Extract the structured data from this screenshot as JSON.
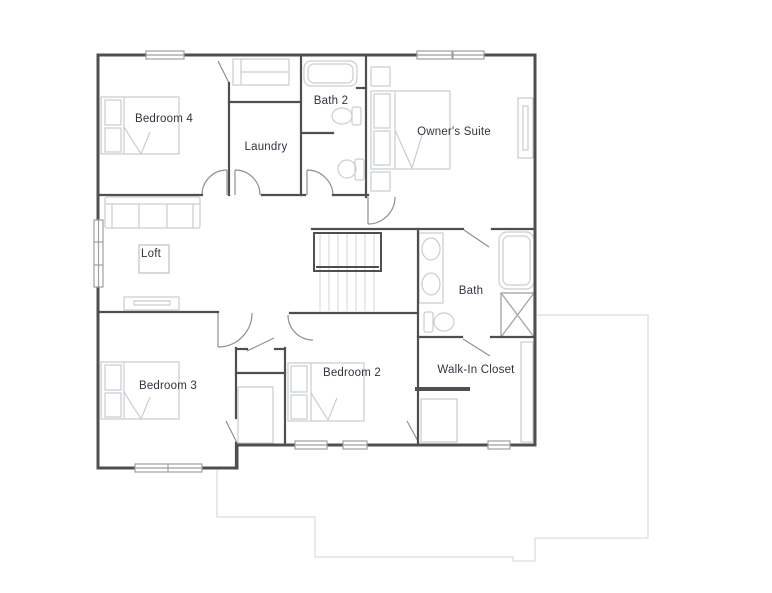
{
  "plan": {
    "type": "floor-plan",
    "floor": "second-floor",
    "background": "#ffffff",
    "colors": {
      "wall": "#4f4f4f",
      "interior_wall": "#585858",
      "door": "#8f8f8f",
      "window_frame": "#9f9f9f",
      "furniture": "#c9cdd1",
      "stair_tread": "#d6d6d6",
      "lower_floor_outline": "#e2e2e2",
      "label_text": "#31343d"
    },
    "rooms": {
      "bedroom4": {
        "label": "Bedroom 4"
      },
      "laundry": {
        "label": "Laundry"
      },
      "bath2": {
        "label": "Bath 2"
      },
      "owners_suite": {
        "label": "Owner's Suite"
      },
      "loft": {
        "label": "Loft"
      },
      "bath": {
        "label": "Bath"
      },
      "bedroom3": {
        "label": "Bedroom 3"
      },
      "bedroom2": {
        "label": "Bedroom 2"
      },
      "walk_in_closet": {
        "label": "Walk-In Closet"
      }
    },
    "fixtures": [
      "bed-icon x4",
      "nightstand-icon x2",
      "couch-icon",
      "tv-console-icon",
      "bathtub-icon x2",
      "shower-icon",
      "double-vanity-icon",
      "toilet-icon x2",
      "pedestal-sink-icon",
      "stairs-icon",
      "closet-shelf-icon x3",
      "window-icon x8",
      "door-arc-icon x7",
      "lower-floor-outline"
    ]
  }
}
